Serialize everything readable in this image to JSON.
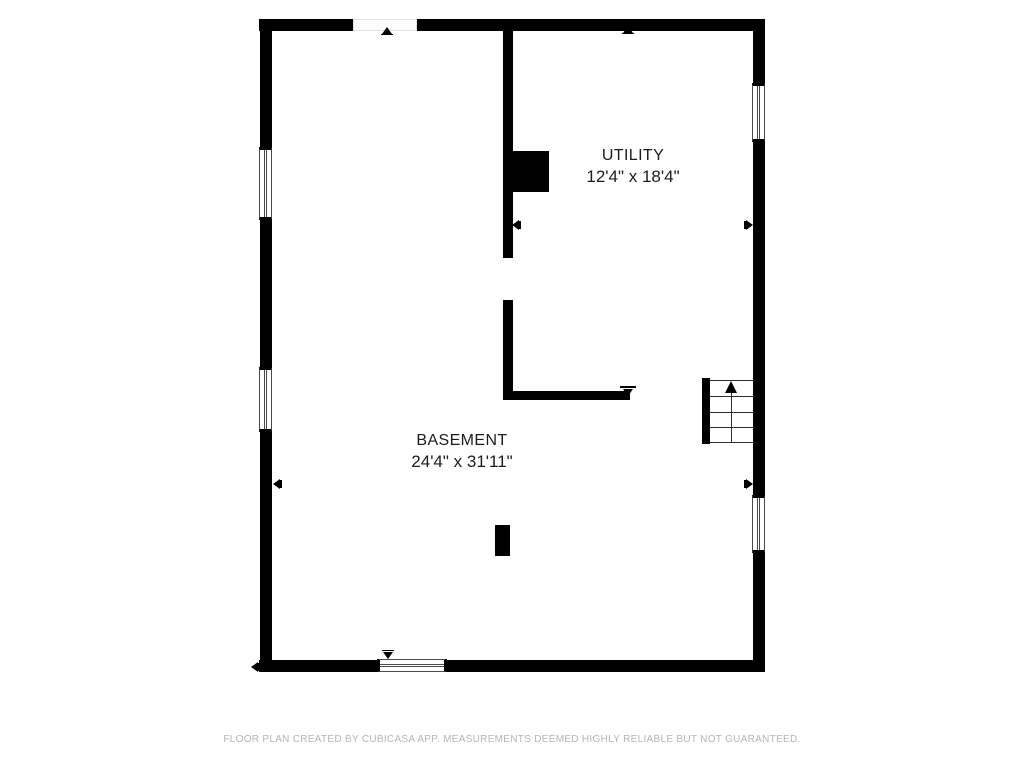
{
  "rooms": [
    {
      "name": "UTILITY",
      "dimensions": "12'4\" x 18'4\""
    },
    {
      "name": "BASEMENT",
      "dimensions": "24'4\" x 31'11\""
    }
  ],
  "footer": {
    "disclaimer": "FLOOR PLAN CREATED BY CUBICASA APP. MEASUREMENTS DEEMED HIGHLY RELIABLE BUT NOT GUARANTEED."
  },
  "icons": {
    "stair_up_arrow": "up-triangle",
    "opening_marker": "small-black-triangle"
  },
  "colors": {
    "wall": "#000000",
    "background": "#ffffff",
    "label_text": "#1c1c1c",
    "footer_text": "#b5b5b5"
  }
}
